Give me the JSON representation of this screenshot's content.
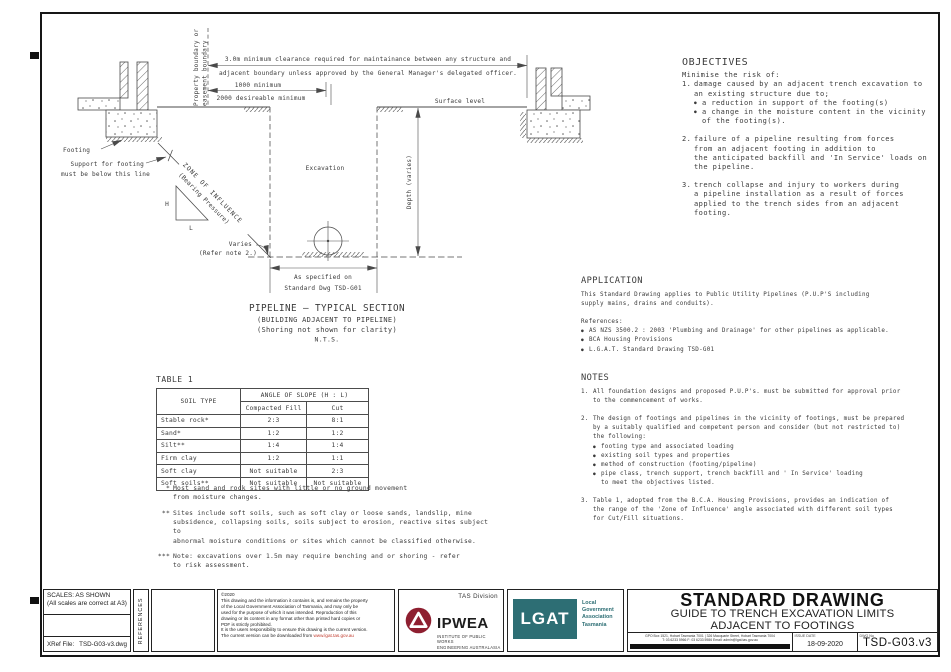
{
  "colors": {
    "ink": "#3a3a3a",
    "ipwea_red": "#8e1f30",
    "lgat_teal": "#2d6e74",
    "url_red": "#c0392b",
    "bar_black": "#111111"
  },
  "glyphs": {
    "bullet": "●"
  },
  "diagram": {
    "boundary1": "Property boundary or",
    "boundary2": "easement boundary",
    "clearance1": "3.0m minimum clearance required for maintainance between any structure and",
    "clearance2": "adjacent boundary unless approved by the General Manager's delegated officer.",
    "dim1000": "1000 minimum",
    "dim2000": "2000 desireable minimum",
    "surface": "Surface level",
    "footing": "Footing",
    "support1": "Support for footing",
    "support2": "must be below this line",
    "zone1": "ZONE OF INFLUENCE",
    "zone2": "(Bearing Pressure)",
    "h": "H",
    "l": "L",
    "excavation": "Excavation",
    "depth": "Depth (varies)",
    "varies1": "Varies",
    "varies2": "(Refer note 2.)",
    "width1": "As specified on",
    "width2": "Standard Dwg TSD-G01",
    "cap1": "PIPELINE — TYPICAL SECTION",
    "cap2": "(BUILDING ADJACENT TO PIPELINE)",
    "cap3": "(Shoring not shown for clarity)",
    "cap4": "N.T.S."
  },
  "table": {
    "title": "TABLE 1",
    "header": {
      "soil": "SOIL TYPE",
      "angle": "ANGLE OF SLOPE (H : L)",
      "fill": "Compacted Fill",
      "cut": "Cut"
    },
    "rows": [
      {
        "soil": "Stable rock*",
        "fill": "2:3",
        "cut": "8:1"
      },
      {
        "soil": "Sand*",
        "fill": "1:2",
        "cut": "1:2"
      },
      {
        "soil": "Silt**",
        "fill": "1:4",
        "cut": "1:4"
      },
      {
        "soil": "Firm clay",
        "fill": "1:2",
        "cut": "1:1"
      },
      {
        "soil": "Soft clay",
        "fill": "Not suitable",
        "cut": "2:3"
      },
      {
        "soil": "Soft soils**",
        "fill": "Not suitable",
        "cut": "Not suitable"
      }
    ],
    "footnotes": [
      {
        "marker": "*",
        "text": "Most sand and rock sites with little or no ground movement\nfrom moisture changes."
      },
      {
        "marker": "**",
        "text": "Sites include soft soils, such as soft clay or loose sands, landslip, mine\nsubsidence, collapsing soils, soils subject to erosion, reactive sites subject to\nabnormal moisture conditions or sites which cannot be classified otherwise."
      },
      {
        "marker": "***",
        "text": "Note: excavations over 1.5m may require benching and or shoring - refer\nto risk assessment."
      }
    ]
  },
  "objectives": {
    "heading": "OBJECTIVES",
    "intro": "Minimise the risk of:",
    "items": [
      {
        "num": "1.",
        "text": "damage caused by an adjacent trench excavation to\nan existing structure due to;",
        "bullets": [
          "a reduction in support of the footing(s)",
          "a change in the moisture content in the vicinity\nof the footing(s)."
        ]
      },
      {
        "num": "2.",
        "text": "failure of a pipeline resulting from forces\nfrom an adjacent footing in addition to\nthe anticipated backfill and 'In Service' loads on\nthe pipeline."
      },
      {
        "num": "3.",
        "text": "trench collapse and injury to workers during\na pipeline installation as a result of forces\napplied to the trench sides from an adjacent\nfooting."
      }
    ]
  },
  "application": {
    "heading": "APPLICATION",
    "body": "This Standard Drawing applies to Public Utility Pipelines (P.U.P'S including\nsupply mains, drains and conduits).",
    "references_label": "References:",
    "references": [
      "AS NZS 3500.2 : 2003 'Plumbing and Drainage' for other pipelines as applicable.",
      "BCA Housing Provisions",
      "L.G.A.T. Standard Drawing TSD-G01"
    ]
  },
  "notes": {
    "heading": "NOTES",
    "items": [
      {
        "num": "1.",
        "text": "All foundation designs and proposed P.U.P's. must be submitted for approval prior\nto the commencement of works."
      },
      {
        "num": "2.",
        "text": "The design of footings and pipelines in the vicinity of footings, must be prepared\nby a suitably qualified and competent person and consider (but not restricted to)\nthe following:",
        "bullets": [
          "footing type and associated loading",
          "existing soil types and properties",
          "method of construction (footing/pipeline)",
          "pipe class, trench support, trench backfill and ' In Service' loading\nto meet the objectives listed."
        ]
      },
      {
        "num": "3.",
        "text": "Table 1, adopted from the B.C.A. Housing Provisions, provides an indication of\nthe range of the 'Zone of Influence' angle associated with different soil types\nfor Cut/Fill situations."
      }
    ]
  },
  "titleblock": {
    "scales_line1": "SCALES:  AS SHOWN",
    "scales_line2": "(All scales are correct at A3)",
    "xref_label": "XRef File:",
    "xref_value": "TSD-G03-v3.dwg",
    "references_label": "REFERENCES",
    "copyright": {
      "year": "©2020",
      "notice": "This drawing and the information it contains is, and remains the property\nof the Local Government Association of Tasmania, and may only be\nused for the purpose of which it was intended. Reproduction of this\ndrawing or its content in any format other than printed hard copies or\nPDF is strictly prohibited.",
      "version_prefix": "It is the users responsibility to ensure this drawing is the current version.\nThe current version can be downloaded from ",
      "url": "www.lgat.tas.gov.au"
    },
    "ipwea": {
      "division": "TAS  Division",
      "name": "IPWEA",
      "sub1": "INSTITUTE OF PUBLIC WORKS",
      "sub2": "ENGINEERING AUSTRALASIA"
    },
    "lgat": {
      "acronym": "LGAT",
      "line1": "Local",
      "line2": "Government",
      "line3": "Association",
      "line4": "Tasmania"
    },
    "title": {
      "main": "STANDARD DRAWING",
      "sub1": "GUIDE TO TRENCH EXCAVATION LIMITS",
      "sub2": "ADJACENT TO FOOTINGS"
    },
    "address_line1": "GPO Box 1521, Hobart Tasmania 7001 | 326 Macquarie Street, Hobart Tasmania 7004",
    "address_line2": "T: 03 6233 5966   F: 03 6233 5986   Email: admin@lgat.tas.gov.au",
    "issue_label": "ISSUE DATE",
    "issue_value": "18-09-2020",
    "dwg_label": "DWG No",
    "dwg_value": "TSD-G03.v3"
  }
}
